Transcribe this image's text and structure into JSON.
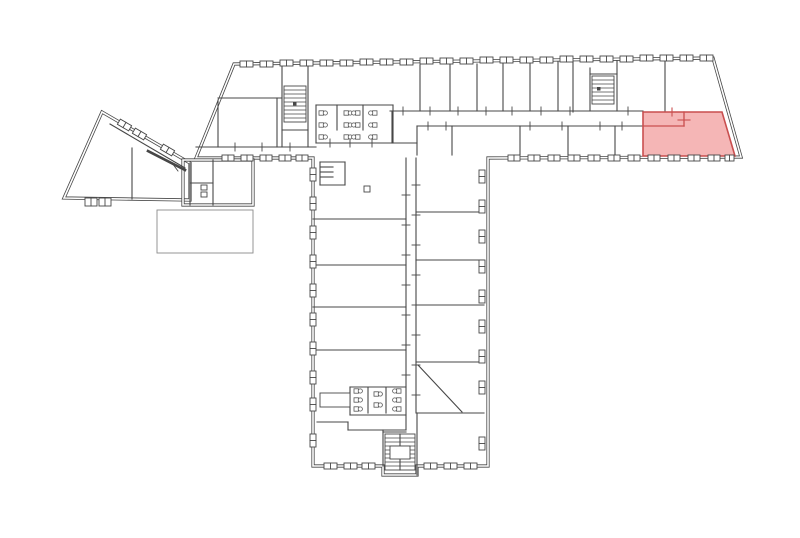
{
  "meta": {
    "type": "architectural-floor-plan",
    "canvas": {
      "width": 800,
      "height": 538
    },
    "colors": {
      "background": "#ffffff",
      "wall": "#474747",
      "thin": "#8a8a8a",
      "white": "#ffffff",
      "highlight_fill": "#F29E9E",
      "highlight_stroke": "#C94F4F"
    }
  },
  "plan": {
    "outlines": [
      {
        "name": "main-wing",
        "points": [
          [
            234,
            64
          ],
          [
            713,
            58
          ],
          [
            741,
            157
          ],
          [
            488,
            158
          ],
          [
            488,
            466
          ],
          [
            417,
            466
          ],
          [
            417,
            475
          ],
          [
            383,
            475
          ],
          [
            383,
            466
          ],
          [
            313,
            466
          ],
          [
            313,
            158
          ],
          [
            196,
            158
          ]
        ]
      },
      {
        "name": "angled-wing",
        "points": [
          [
            102,
            112
          ],
          [
            190,
            163
          ],
          [
            190,
            200
          ],
          [
            64,
            198
          ]
        ]
      },
      {
        "name": "annex",
        "points": [
          [
            183,
            160
          ],
          [
            253,
            160
          ],
          [
            253,
            205
          ],
          [
            183,
            205
          ]
        ]
      }
    ],
    "walls": [
      [
        420,
        65,
        420,
        111
      ],
      [
        450,
        64,
        450,
        111
      ],
      [
        477,
        64,
        477,
        111
      ],
      [
        503,
        63,
        503,
        111
      ],
      [
        530,
        63,
        530,
        111
      ],
      [
        558,
        62,
        558,
        111
      ],
      [
        573,
        62,
        573,
        112
      ],
      [
        590,
        68,
        590,
        111
      ],
      [
        617,
        61,
        617,
        111
      ],
      [
        665,
        60,
        665,
        111
      ],
      [
        282,
        66,
        282,
        147
      ],
      [
        308,
        64,
        308,
        147
      ],
      [
        282,
        130,
        308,
        130
      ],
      [
        218,
        100,
        218,
        147
      ],
      [
        218,
        98,
        282,
        98
      ],
      [
        277,
        98,
        277,
        147
      ],
      [
        390,
        111,
        643,
        111
      ],
      [
        196,
        147,
        316,
        147
      ],
      [
        316,
        143,
        417,
        143
      ],
      [
        392,
        111,
        392,
        143
      ],
      [
        417,
        126,
        417,
        155
      ],
      [
        417,
        126,
        643,
        126
      ],
      [
        590,
        74,
        617,
        74
      ],
      [
        452,
        126,
        452,
        155
      ],
      [
        520,
        126,
        520,
        155
      ],
      [
        568,
        126,
        568,
        155
      ],
      [
        615,
        126,
        615,
        155
      ],
      [
        316,
        105,
        393,
        105
      ],
      [
        316,
        105,
        316,
        143
      ],
      [
        393,
        105,
        393,
        143
      ],
      [
        337,
        105,
        337,
        130
      ],
      [
        363,
        105,
        363,
        130
      ],
      [
        406,
        158,
        406,
        430
      ],
      [
        416,
        158,
        416,
        413
      ],
      [
        313,
        219,
        406,
        219
      ],
      [
        313,
        265,
        406,
        265
      ],
      [
        313,
        307,
        406,
        307
      ],
      [
        313,
        350,
        406,
        350
      ],
      [
        350,
        387,
        406,
        387
      ],
      [
        350,
        387,
        350,
        415
      ],
      [
        350,
        415,
        406,
        415
      ],
      [
        368,
        388,
        368,
        413
      ],
      [
        386,
        388,
        386,
        413
      ],
      [
        317,
        422,
        348,
        422
      ],
      [
        348,
        422,
        348,
        430
      ],
      [
        348,
        430,
        406,
        430
      ],
      [
        383,
        430,
        383,
        466
      ],
      [
        416,
        212,
        484,
        212
      ],
      [
        416,
        260,
        484,
        260
      ],
      [
        416,
        305,
        484,
        305
      ],
      [
        416,
        362,
        484,
        362
      ],
      [
        417,
        413,
        484,
        413
      ],
      [
        417,
        413,
        417,
        475
      ],
      [
        383,
        432,
        406,
        432
      ],
      [
        400,
        434,
        400,
        470
      ],
      [
        320,
        162,
        345,
        162
      ],
      [
        345,
        162,
        345,
        185
      ],
      [
        320,
        185,
        345,
        185
      ],
      [
        320,
        162,
        320,
        185
      ],
      [
        321,
        167,
        333,
        167
      ],
      [
        321,
        172,
        333,
        172
      ],
      [
        321,
        177,
        333,
        177
      ],
      [
        190,
        163,
        190,
        205
      ],
      [
        213,
        160,
        213,
        205
      ],
      [
        190,
        183,
        213,
        183
      ],
      [
        110,
        124,
        185,
        168
      ],
      [
        132,
        148,
        132,
        199
      ],
      [
        418,
        365,
        462,
        412
      ]
    ],
    "thick_walls": [
      [
        148,
        151,
        185,
        170
      ]
    ],
    "rects": [
      {
        "x": 157,
        "y": 210,
        "w": 96,
        "h": 43,
        "thin": true,
        "name": "terrace"
      },
      {
        "x": 364,
        "y": 186,
        "w": 6,
        "h": 6,
        "name": "column"
      },
      {
        "x": 320,
        "y": 393,
        "w": 30,
        "h": 14,
        "name": "closet"
      },
      {
        "x": 201,
        "y": 185,
        "w": 6,
        "h": 5,
        "name": "annex-fixture"
      },
      {
        "x": 201,
        "y": 192,
        "w": 6,
        "h": 5,
        "name": "annex-fixture"
      },
      {
        "x": 390,
        "y": 446,
        "w": 20,
        "h": 13,
        "name": "stair-landing"
      }
    ],
    "windows": [
      {
        "x": 240,
        "y": 61,
        "w": 13,
        "h": 6
      },
      {
        "x": 260,
        "y": 61,
        "w": 13,
        "h": 6
      },
      {
        "x": 280,
        "y": 60,
        "w": 13,
        "h": 6
      },
      {
        "x": 300,
        "y": 60,
        "w": 13,
        "h": 6
      },
      {
        "x": 320,
        "y": 60,
        "w": 13,
        "h": 6
      },
      {
        "x": 340,
        "y": 60,
        "w": 13,
        "h": 6
      },
      {
        "x": 360,
        "y": 59,
        "w": 13,
        "h": 6
      },
      {
        "x": 380,
        "y": 59,
        "w": 13,
        "h": 6
      },
      {
        "x": 400,
        "y": 59,
        "w": 13,
        "h": 6
      },
      {
        "x": 420,
        "y": 58,
        "w": 13,
        "h": 6
      },
      {
        "x": 440,
        "y": 58,
        "w": 13,
        "h": 6
      },
      {
        "x": 460,
        "y": 58,
        "w": 13,
        "h": 6
      },
      {
        "x": 480,
        "y": 57,
        "w": 13,
        "h": 6
      },
      {
        "x": 500,
        "y": 57,
        "w": 13,
        "h": 6
      },
      {
        "x": 520,
        "y": 57,
        "w": 13,
        "h": 6
      },
      {
        "x": 540,
        "y": 57,
        "w": 13,
        "h": 6
      },
      {
        "x": 560,
        "y": 56,
        "w": 13,
        "h": 6
      },
      {
        "x": 580,
        "y": 56,
        "w": 13,
        "h": 6
      },
      {
        "x": 600,
        "y": 56,
        "w": 13,
        "h": 6
      },
      {
        "x": 620,
        "y": 56,
        "w": 13,
        "h": 6
      },
      {
        "x": 640,
        "y": 55,
        "w": 13,
        "h": 6
      },
      {
        "x": 660,
        "y": 55,
        "w": 13,
        "h": 6
      },
      {
        "x": 680,
        "y": 55,
        "w": 13,
        "h": 6
      },
      {
        "x": 700,
        "y": 55,
        "w": 13,
        "h": 6
      },
      {
        "x": 222,
        "y": 155,
        "w": 12,
        "h": 6
      },
      {
        "x": 241,
        "y": 155,
        "w": 12,
        "h": 6
      },
      {
        "x": 260,
        "y": 155,
        "w": 12,
        "h": 6
      },
      {
        "x": 279,
        "y": 155,
        "w": 12,
        "h": 6
      },
      {
        "x": 296,
        "y": 155,
        "w": 12,
        "h": 6
      },
      {
        "x": 508,
        "y": 155,
        "w": 12,
        "h": 6
      },
      {
        "x": 528,
        "y": 155,
        "w": 12,
        "h": 6
      },
      {
        "x": 548,
        "y": 155,
        "w": 12,
        "h": 6
      },
      {
        "x": 568,
        "y": 155,
        "w": 12,
        "h": 6
      },
      {
        "x": 588,
        "y": 155,
        "w": 12,
        "h": 6
      },
      {
        "x": 608,
        "y": 155,
        "w": 12,
        "h": 6
      },
      {
        "x": 628,
        "y": 155,
        "w": 12,
        "h": 6
      },
      {
        "x": 648,
        "y": 155,
        "w": 12,
        "h": 6
      },
      {
        "x": 668,
        "y": 155,
        "w": 12,
        "h": 6
      },
      {
        "x": 688,
        "y": 155,
        "w": 12,
        "h": 6
      },
      {
        "x": 708,
        "y": 155,
        "w": 12,
        "h": 6
      },
      {
        "x": 725,
        "y": 155,
        "w": 9,
        "h": 6
      },
      {
        "x": 310,
        "y": 168,
        "w": 6,
        "h": 13
      },
      {
        "x": 310,
        "y": 197,
        "w": 6,
        "h": 13
      },
      {
        "x": 310,
        "y": 226,
        "w": 6,
        "h": 13
      },
      {
        "x": 310,
        "y": 255,
        "w": 6,
        "h": 13
      },
      {
        "x": 310,
        "y": 284,
        "w": 6,
        "h": 13
      },
      {
        "x": 310,
        "y": 313,
        "w": 6,
        "h": 13
      },
      {
        "x": 310,
        "y": 342,
        "w": 6,
        "h": 13
      },
      {
        "x": 310,
        "y": 371,
        "w": 6,
        "h": 13
      },
      {
        "x": 310,
        "y": 398,
        "w": 6,
        "h": 13
      },
      {
        "x": 310,
        "y": 434,
        "w": 6,
        "h": 13
      },
      {
        "x": 479,
        "y": 170,
        "w": 6,
        "h": 13
      },
      {
        "x": 479,
        "y": 200,
        "w": 6,
        "h": 13
      },
      {
        "x": 479,
        "y": 230,
        "w": 6,
        "h": 13
      },
      {
        "x": 479,
        "y": 260,
        "w": 6,
        "h": 13
      },
      {
        "x": 479,
        "y": 290,
        "w": 6,
        "h": 13
      },
      {
        "x": 479,
        "y": 320,
        "w": 6,
        "h": 13
      },
      {
        "x": 479,
        "y": 350,
        "w": 6,
        "h": 13
      },
      {
        "x": 479,
        "y": 381,
        "w": 6,
        "h": 13
      },
      {
        "x": 479,
        "y": 437,
        "w": 6,
        "h": 13
      },
      {
        "x": 324,
        "y": 463,
        "w": 13,
        "h": 6
      },
      {
        "x": 344,
        "y": 463,
        "w": 13,
        "h": 6
      },
      {
        "x": 362,
        "y": 463,
        "w": 13,
        "h": 6
      },
      {
        "x": 424,
        "y": 463,
        "w": 13,
        "h": 6
      },
      {
        "x": 444,
        "y": 463,
        "w": 13,
        "h": 6
      },
      {
        "x": 464,
        "y": 463,
        "w": 13,
        "h": 6
      },
      {
        "x": 118,
        "y": 122,
        "w": 13,
        "h": 6,
        "rot": 30
      },
      {
        "x": 133,
        "y": 131,
        "w": 13,
        "h": 6,
        "rot": 30
      },
      {
        "x": 161,
        "y": 147,
        "w": 13,
        "h": 6,
        "rot": 30
      },
      {
        "x": 85,
        "y": 198,
        "w": 12,
        "h": 8
      },
      {
        "x": 99,
        "y": 198,
        "w": 12,
        "h": 8
      }
    ],
    "stairs": [
      {
        "x": 284,
        "y": 86,
        "w": 22,
        "h": 36,
        "step": 4
      },
      {
        "x": 592,
        "y": 76,
        "w": 22,
        "h": 28,
        "step": 4
      },
      {
        "x": 385,
        "y": 434,
        "w": 30,
        "h": 36,
        "step": 4
      }
    ],
    "stair_dots": [
      [
        293,
        102
      ],
      [
        597,
        87
      ]
    ],
    "fixtures": [
      {
        "x": 319,
        "y": 113,
        "rot": 0
      },
      {
        "x": 319,
        "y": 125,
        "rot": 0
      },
      {
        "x": 319,
        "y": 137,
        "rot": 0
      },
      {
        "x": 344,
        "y": 113,
        "rot": 0
      },
      {
        "x": 344,
        "y": 125,
        "rot": 0
      },
      {
        "x": 344,
        "y": 137,
        "rot": 0
      },
      {
        "x": 360,
        "y": 113,
        "rot": 180
      },
      {
        "x": 360,
        "y": 125,
        "rot": 180
      },
      {
        "x": 360,
        "y": 137,
        "rot": 180
      },
      {
        "x": 377,
        "y": 113,
        "rot": 180
      },
      {
        "x": 377,
        "y": 125,
        "rot": 180
      },
      {
        "x": 377,
        "y": 137,
        "rot": 180
      },
      {
        "x": 354,
        "y": 391,
        "rot": 0
      },
      {
        "x": 354,
        "y": 400,
        "rot": 0
      },
      {
        "x": 354,
        "y": 409,
        "rot": 0
      },
      {
        "x": 374,
        "y": 394,
        "rot": 0
      },
      {
        "x": 374,
        "y": 405,
        "rot": 0
      },
      {
        "x": 401,
        "y": 391,
        "rot": 180
      },
      {
        "x": 401,
        "y": 400,
        "rot": 180
      },
      {
        "x": 401,
        "y": 409,
        "rot": 180
      }
    ],
    "ticks": [
      [
        403,
        107,
        403,
        115
      ],
      [
        430,
        107,
        430,
        115
      ],
      [
        458,
        107,
        458,
        115
      ],
      [
        486,
        107,
        486,
        115
      ],
      [
        512,
        107,
        512,
        115
      ],
      [
        541,
        107,
        541,
        115
      ],
      [
        570,
        107,
        570,
        115
      ],
      [
        628,
        107,
        628,
        115
      ],
      [
        428,
        122,
        428,
        130
      ],
      [
        446,
        122,
        446,
        130
      ],
      [
        530,
        122,
        530,
        130
      ],
      [
        562,
        122,
        562,
        130
      ],
      [
        600,
        122,
        600,
        130
      ],
      [
        622,
        122,
        622,
        130
      ],
      [
        235,
        143,
        235,
        151
      ],
      [
        262,
        143,
        262,
        151
      ],
      [
        290,
        143,
        290,
        151
      ],
      [
        330,
        139,
        330,
        147
      ],
      [
        350,
        139,
        350,
        147
      ],
      [
        372,
        139,
        372,
        147
      ],
      [
        402,
        195,
        410,
        195
      ],
      [
        402,
        225,
        410,
        225
      ],
      [
        402,
        255,
        410,
        255
      ],
      [
        402,
        285,
        410,
        285
      ],
      [
        402,
        315,
        410,
        315
      ],
      [
        402,
        345,
        410,
        345
      ],
      [
        402,
        375,
        410,
        375
      ],
      [
        412,
        185,
        420,
        185
      ],
      [
        412,
        215,
        420,
        215
      ],
      [
        412,
        245,
        420,
        245
      ],
      [
        412,
        275,
        420,
        275
      ],
      [
        412,
        305,
        420,
        305
      ],
      [
        412,
        335,
        420,
        335
      ],
      [
        412,
        365,
        420,
        365
      ],
      [
        412,
        395,
        420,
        395
      ],
      [
        172,
        163,
        178,
        171
      ]
    ],
    "highlight": {
      "name": "selected-unit",
      "points": [
        [
          643,
          112
        ],
        [
          722,
          112
        ],
        [
          735,
          156
        ],
        [
          643,
          156
        ]
      ],
      "fill_opacity": 0.75,
      "inner_walls": [
        [
          643,
          126,
          684,
          126
        ],
        [
          684,
          112,
          684,
          126
        ]
      ],
      "ticks": [
        [
          672,
          108,
          672,
          116
        ],
        [
          678,
          120,
          690,
          120
        ]
      ]
    }
  }
}
